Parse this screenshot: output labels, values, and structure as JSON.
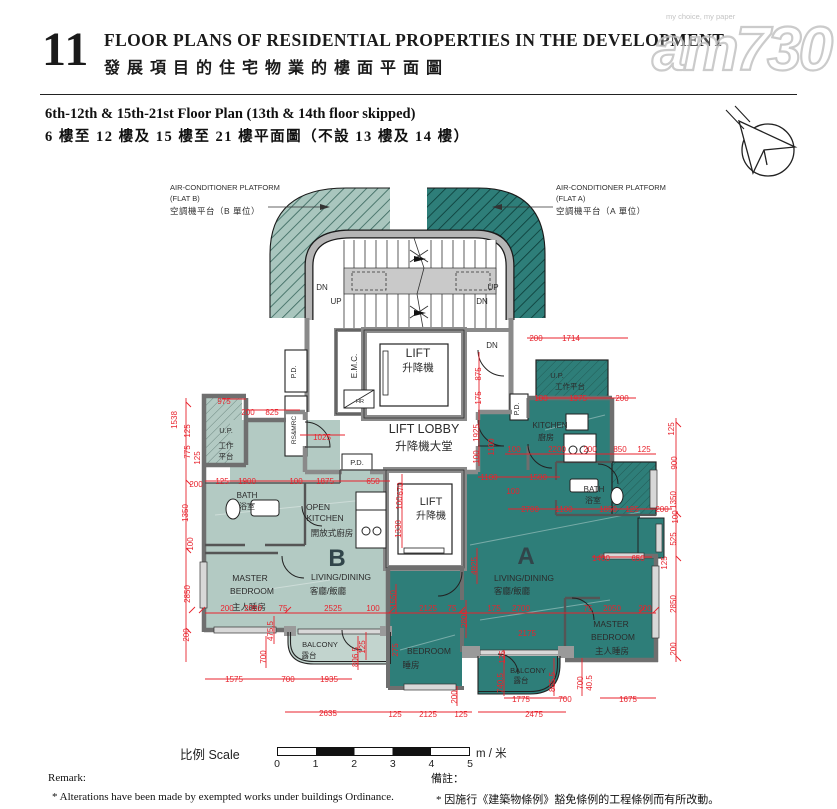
{
  "header": {
    "section_number": "11",
    "title_en": "FLOOR PLANS OF RESIDENTIAL PROPERTIES IN THE DEVELOPMENT",
    "title_zh": "發展項目的住宅物業的樓面平面圖",
    "watermark": {
      "brand": "am730",
      "tagline": "my choice, my paper"
    }
  },
  "subtitle": {
    "en": "6th-12th & 15th-21st Floor Plan (13th & 14th floor skipped)",
    "zh": "6 樓至 12 樓及 15 樓至 21 樓平面圖（不設 13 樓及 14 樓）"
  },
  "colors": {
    "flat_a": "#2e7e79",
    "flat_b": "#b3cac3",
    "balcony_b": "#c2d4ce",
    "dimension": "#e8232d",
    "wall": "#8a8a8a"
  },
  "ac_platform": {
    "left": {
      "l1": "AIR-CONDITIONER PLATFORM",
      "l2": "(FLAT B)",
      "l3": "空調機平台（B 單位）"
    },
    "right": {
      "l1": "AIR-CONDITIONER PLATFORM",
      "l2": "(FLAT A)",
      "l3": "空調機平台（A 單位）"
    }
  },
  "plan": {
    "labels": [
      {
        "t": "LIFT",
        "x": 418,
        "y": 357,
        "s": 12
      },
      {
        "t": "升降機",
        "x": 418,
        "y": 371,
        "s": 10.5
      },
      {
        "t": "LIFT LOBBY",
        "x": 424,
        "y": 433,
        "s": 12.5
      },
      {
        "t": "升降機大堂",
        "x": 424,
        "y": 450,
        "s": 11.5
      },
      {
        "t": "LIFT",
        "x": 431,
        "y": 505,
        "s": 11
      },
      {
        "t": "升降機",
        "x": 431,
        "y": 519,
        "s": 10
      },
      {
        "t": "E.M.C.",
        "x": 357,
        "y": 366,
        "s": 8,
        "r": 1
      },
      {
        "t": "P.D.",
        "x": 296,
        "y": 372,
        "s": 7,
        "r": 1
      },
      {
        "t": "RS&MRC",
        "x": 296,
        "y": 430,
        "s": 6.5,
        "r": 1
      },
      {
        "t": "P.D.",
        "x": 357,
        "y": 465,
        "s": 7.5
      },
      {
        "t": "P.D.",
        "x": 519,
        "y": 409,
        "s": 7,
        "r": 1
      },
      {
        "t": "HR",
        "x": 360,
        "y": 403,
        "s": 5.5
      },
      {
        "t": "U.P.",
        "x": 226,
        "y": 433,
        "s": 7.5
      },
      {
        "t": "工作",
        "x": 226,
        "y": 448,
        "s": 7.5
      },
      {
        "t": "平台",
        "x": 226,
        "y": 459,
        "s": 7.5
      },
      {
        "t": "BATH",
        "x": 247,
        "y": 498,
        "s": 8
      },
      {
        "t": "浴室",
        "x": 247,
        "y": 509,
        "s": 8
      },
      {
        "t": "OPEN",
        "x": 318,
        "y": 510,
        "s": 8.5
      },
      {
        "t": "KITCHEN",
        "x": 325,
        "y": 521,
        "s": 8.5
      },
      {
        "t": "開放式廚房",
        "x": 332,
        "y": 536,
        "s": 8.5
      },
      {
        "t": "B",
        "x": 337,
        "y": 566,
        "s": 24,
        "c": "big"
      },
      {
        "t": "LIVING/DINING",
        "x": 341,
        "y": 580,
        "s": 8.5
      },
      {
        "t": "客廳/飯廳",
        "x": 328,
        "y": 594,
        "s": 8.5
      },
      {
        "t": "MASTER",
        "x": 250,
        "y": 581,
        "s": 8.5
      },
      {
        "t": "BEDROOM",
        "x": 252,
        "y": 594,
        "s": 8.5
      },
      {
        "t": "主人睡房",
        "x": 249,
        "y": 610,
        "s": 8.5
      },
      {
        "t": "BALCONY",
        "x": 320,
        "y": 647,
        "s": 7.5
      },
      {
        "t": "露台",
        "x": 309,
        "y": 658,
        "s": 7.5
      },
      {
        "t": "U.P.",
        "x": 557,
        "y": 378,
        "s": 7.5
      },
      {
        "t": "工作平台",
        "x": 570,
        "y": 389,
        "s": 7.5
      },
      {
        "t": "KITCHEN",
        "x": 550,
        "y": 428,
        "s": 8
      },
      {
        "t": "廚房",
        "x": 546,
        "y": 440,
        "s": 8
      },
      {
        "t": "BATH",
        "x": 594,
        "y": 492,
        "s": 8
      },
      {
        "t": "浴室",
        "x": 593,
        "y": 503,
        "s": 8
      },
      {
        "t": "A",
        "x": 526,
        "y": 564,
        "s": 24,
        "c": "big"
      },
      {
        "t": "LIVING/DINING",
        "x": 524,
        "y": 581,
        "s": 8.5
      },
      {
        "t": "客廳/飯廳",
        "x": 512,
        "y": 594,
        "s": 8.5
      },
      {
        "t": "BEDROOM",
        "x": 429,
        "y": 654,
        "s": 8.5
      },
      {
        "t": "睡房",
        "x": 411,
        "y": 668,
        "s": 8.5
      },
      {
        "t": "MASTER",
        "x": 611,
        "y": 627,
        "s": 8.5
      },
      {
        "t": "BEDROOM",
        "x": 613,
        "y": 640,
        "s": 8.5
      },
      {
        "t": "主人睡房",
        "x": 612,
        "y": 654,
        "s": 8.5
      },
      {
        "t": "BALCONY",
        "x": 528,
        "y": 673,
        "s": 7.5
      },
      {
        "t": "露台",
        "x": 521,
        "y": 683,
        "s": 7.5
      },
      {
        "t": "DN",
        "x": 322,
        "y": 290,
        "s": 8
      },
      {
        "t": "UP",
        "x": 336,
        "y": 304,
        "s": 8
      },
      {
        "t": "UP",
        "x": 493,
        "y": 290,
        "s": 8
      },
      {
        "t": "DN",
        "x": 482,
        "y": 304,
        "s": 8
      },
      {
        "t": "DN",
        "x": 492,
        "y": 348,
        "s": 8
      }
    ],
    "dims": [
      {
        "t": "975",
        "x": 224,
        "y": 404
      },
      {
        "t": "200",
        "x": 248,
        "y": 415
      },
      {
        "t": "825",
        "x": 272,
        "y": 415
      },
      {
        "t": "1025",
        "x": 322,
        "y": 440
      },
      {
        "t": "125",
        "x": 222,
        "y": 484
      },
      {
        "t": "1900",
        "x": 247,
        "y": 484
      },
      {
        "t": "100",
        "x": 296,
        "y": 484
      },
      {
        "t": "1875",
        "x": 325,
        "y": 484
      },
      {
        "t": "650",
        "x": 373,
        "y": 484
      },
      {
        "t": "200",
        "x": 196,
        "y": 487
      },
      {
        "t": "200",
        "x": 227,
        "y": 611
      },
      {
        "t": "2050",
        "x": 253,
        "y": 611
      },
      {
        "t": "75",
        "x": 283,
        "y": 611
      },
      {
        "t": "2525",
        "x": 333,
        "y": 611
      },
      {
        "t": "100",
        "x": 373,
        "y": 611
      },
      {
        "t": "2125",
        "x": 428,
        "y": 611
      },
      {
        "t": "75",
        "x": 452,
        "y": 611
      },
      {
        "t": "175",
        "x": 494,
        "y": 611
      },
      {
        "t": "2700",
        "x": 521,
        "y": 611
      },
      {
        "t": "75",
        "x": 588,
        "y": 611
      },
      {
        "t": "2050",
        "x": 612,
        "y": 611
      },
      {
        "t": "200",
        "x": 645,
        "y": 611
      },
      {
        "t": "1575",
        "x": 234,
        "y": 682
      },
      {
        "t": "700",
        "x": 288,
        "y": 682
      },
      {
        "t": "1935",
        "x": 329,
        "y": 682
      },
      {
        "t": "2635",
        "x": 328,
        "y": 716
      },
      {
        "t": "125",
        "x": 395,
        "y": 717
      },
      {
        "t": "2125",
        "x": 428,
        "y": 717
      },
      {
        "t": "125",
        "x": 461,
        "y": 717
      },
      {
        "t": "2175",
        "x": 527,
        "y": 636
      },
      {
        "t": "1775",
        "x": 521,
        "y": 702
      },
      {
        "t": "700",
        "x": 565,
        "y": 702
      },
      {
        "t": "2475",
        "x": 534,
        "y": 717
      },
      {
        "t": "1675",
        "x": 628,
        "y": 702
      },
      {
        "t": "1400",
        "x": 601,
        "y": 561
      },
      {
        "t": "650",
        "x": 638,
        "y": 561
      },
      {
        "t": "2700",
        "x": 530,
        "y": 512
      },
      {
        "t": "1100",
        "x": 564,
        "y": 512
      },
      {
        "t": "1850",
        "x": 608,
        "y": 512
      },
      {
        "t": "125",
        "x": 632,
        "y": 512
      },
      {
        "t": "200",
        "x": 662,
        "y": 512
      },
      {
        "t": "1100",
        "x": 489,
        "y": 480
      },
      {
        "t": "1500",
        "x": 538,
        "y": 480
      },
      {
        "t": "100",
        "x": 513,
        "y": 494
      },
      {
        "t": "200",
        "x": 536,
        "y": 341
      },
      {
        "t": "1714",
        "x": 571,
        "y": 341
      },
      {
        "t": "100",
        "x": 541,
        "y": 401
      },
      {
        "t": "1975",
        "x": 578,
        "y": 401
      },
      {
        "t": "200",
        "x": 622,
        "y": 401
      },
      {
        "t": "100",
        "x": 514,
        "y": 452
      },
      {
        "t": "2200",
        "x": 557,
        "y": 452
      },
      {
        "t": "200",
        "x": 590,
        "y": 452
      },
      {
        "t": "850",
        "x": 620,
        "y": 452
      },
      {
        "t": "125",
        "x": 644,
        "y": 452
      },
      {
        "t": "1538",
        "x": 177,
        "y": 420,
        "r": 1
      },
      {
        "t": "125",
        "x": 190,
        "y": 431,
        "r": 1
      },
      {
        "t": "775",
        "x": 190,
        "y": 452,
        "r": 1
      },
      {
        "t": "125",
        "x": 200,
        "y": 458,
        "r": 1
      },
      {
        "t": "1350",
        "x": 188,
        "y": 513,
        "r": 1
      },
      {
        "t": "100",
        "x": 193,
        "y": 544,
        "r": 1
      },
      {
        "t": "2850",
        "x": 190,
        "y": 594,
        "r": 1
      },
      {
        "t": "200",
        "x": 189,
        "y": 635,
        "r": 1
      },
      {
        "t": "475.5",
        "x": 273,
        "y": 631,
        "r": 1
      },
      {
        "t": "700",
        "x": 266,
        "y": 657,
        "r": 1
      },
      {
        "t": "806.5",
        "x": 358,
        "y": 657,
        "r": 1
      },
      {
        "t": "125",
        "x": 365,
        "y": 647,
        "r": 1
      },
      {
        "t": "275",
        "x": 398,
        "y": 650,
        "r": 1
      },
      {
        "t": "2800",
        "x": 467,
        "y": 619,
        "r": 1
      },
      {
        "t": "200",
        "x": 457,
        "y": 697,
        "r": 1
      },
      {
        "t": "670",
        "x": 403,
        "y": 489,
        "r": 1
      },
      {
        "t": "100",
        "x": 402,
        "y": 503,
        "r": 1
      },
      {
        "t": "1330",
        "x": 401,
        "y": 529,
        "r": 1
      },
      {
        "t": "1550",
        "x": 396,
        "y": 599,
        "r": 1
      },
      {
        "t": "4925",
        "x": 477,
        "y": 566,
        "r": 1
      },
      {
        "t": "875",
        "x": 481,
        "y": 374,
        "r": 1
      },
      {
        "t": "175",
        "x": 481,
        "y": 398,
        "r": 1
      },
      {
        "t": "1925",
        "x": 479,
        "y": 433,
        "r": 1
      },
      {
        "t": "1100",
        "x": 494,
        "y": 447,
        "r": 1
      },
      {
        "t": "100",
        "x": 479,
        "y": 457,
        "r": 1
      },
      {
        "t": "125",
        "x": 674,
        "y": 429,
        "r": 1
      },
      {
        "t": "900",
        "x": 677,
        "y": 463,
        "r": 1
      },
      {
        "t": "1350",
        "x": 676,
        "y": 500,
        "r": 1
      },
      {
        "t": "100",
        "x": 678,
        "y": 517,
        "r": 1
      },
      {
        "t": "525",
        "x": 676,
        "y": 539,
        "r": 1
      },
      {
        "t": "125",
        "x": 667,
        "y": 563,
        "r": 1
      },
      {
        "t": "2850",
        "x": 676,
        "y": 604,
        "r": 1
      },
      {
        "t": "200",
        "x": 676,
        "y": 649,
        "r": 1
      },
      {
        "t": "125",
        "x": 505,
        "y": 657,
        "r": 1
      },
      {
        "t": "740.5",
        "x": 503,
        "y": 683,
        "r": 1
      },
      {
        "t": "865.5",
        "x": 555,
        "y": 682,
        "r": 1
      },
      {
        "t": "700",
        "x": 583,
        "y": 683,
        "r": 1
      },
      {
        "t": "40.5",
        "x": 592,
        "y": 683,
        "r": 1
      }
    ]
  },
  "scale_bar": {
    "label": "比例 Scale",
    "unit": "m / 米",
    "ticks": [
      "0",
      "1",
      "2",
      "3",
      "4",
      "5"
    ]
  },
  "remark": {
    "en_title": "Remark:",
    "en_text": "*    Alterations have been made by exempted works under buildings Ordinance.",
    "zh_title": "備註：",
    "zh_text": "*    因施行《建築物條例》豁免條例的工程條例而有所改動。"
  }
}
